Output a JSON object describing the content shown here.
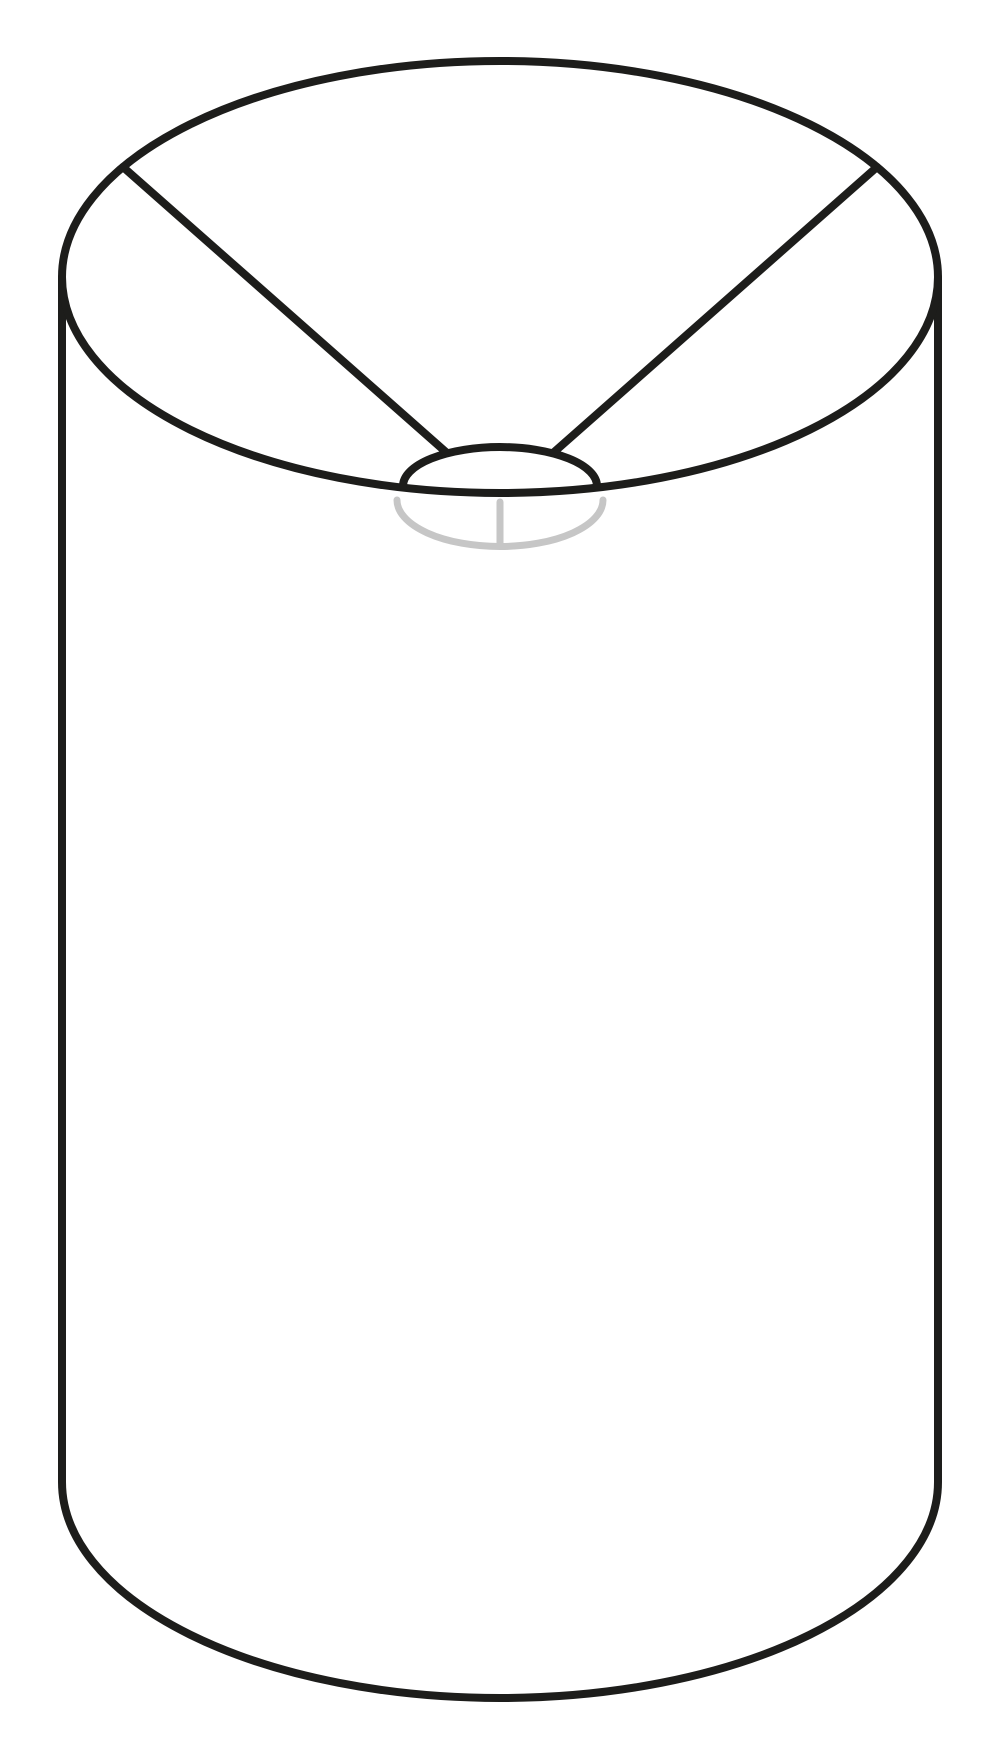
{
  "figure": {
    "title": "Drum lampshade line drawing",
    "description": "Technical line illustration of a tall cylindrical drum lampshade seen slightly from above, with a spider fitter: two black spokes running from the top rim down to a small central ring, and gray hidden lines showing the recessed fitter drop and stem below the rim plane.",
    "background_color": "#ffffff",
    "colors": {
      "outline": "#1d1d1b",
      "hidden": "#c6c6c6",
      "background": "#ffffff"
    },
    "parts": {
      "top_rim": "top rim (ellipse)",
      "body": "cylindrical shade body",
      "bottom_rim": "bottom rim (front arc)",
      "left_spoke": "spider fitter left spoke",
      "right_spoke": "spider fitter right spoke",
      "fitter_ring": "spider fitter center ring",
      "fitter_drop": "fitter drop ring (hidden, gray)",
      "fitter_stem": "fitter center stem (hidden, gray)"
    }
  }
}
